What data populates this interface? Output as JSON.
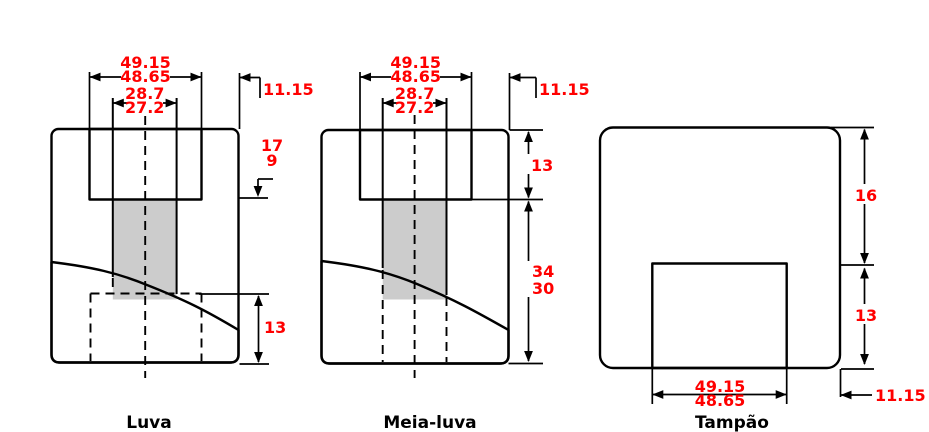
{
  "figures": [
    {
      "label": "Luva",
      "dims": {
        "width_max": "49.15",
        "width_min": "48.65",
        "bore_max": "28.7",
        "bore_min": "27.2",
        "offset": "11.15",
        "depth_max": "17",
        "depth_min": "9",
        "socket_depth": "13"
      }
    },
    {
      "label": "Meia-luva",
      "dims": {
        "width_max": "49.15",
        "width_min": "48.65",
        "bore_max": "28.7",
        "bore_min": "27.2",
        "offset": "11.15",
        "socket_depth": "13",
        "body_depth_max": "34",
        "body_depth_min": "30"
      }
    },
    {
      "label": "Tampão",
      "dims": {
        "top_thickness": "16",
        "plug_depth": "13",
        "width_max": "49.15",
        "width_min": "48.65",
        "offset": "11.15"
      }
    }
  ],
  "colors": {
    "body_fill": "#696969",
    "inner_fill": "#cccccc",
    "outline": "#000000",
    "dimension_text": "#ff0000"
  }
}
